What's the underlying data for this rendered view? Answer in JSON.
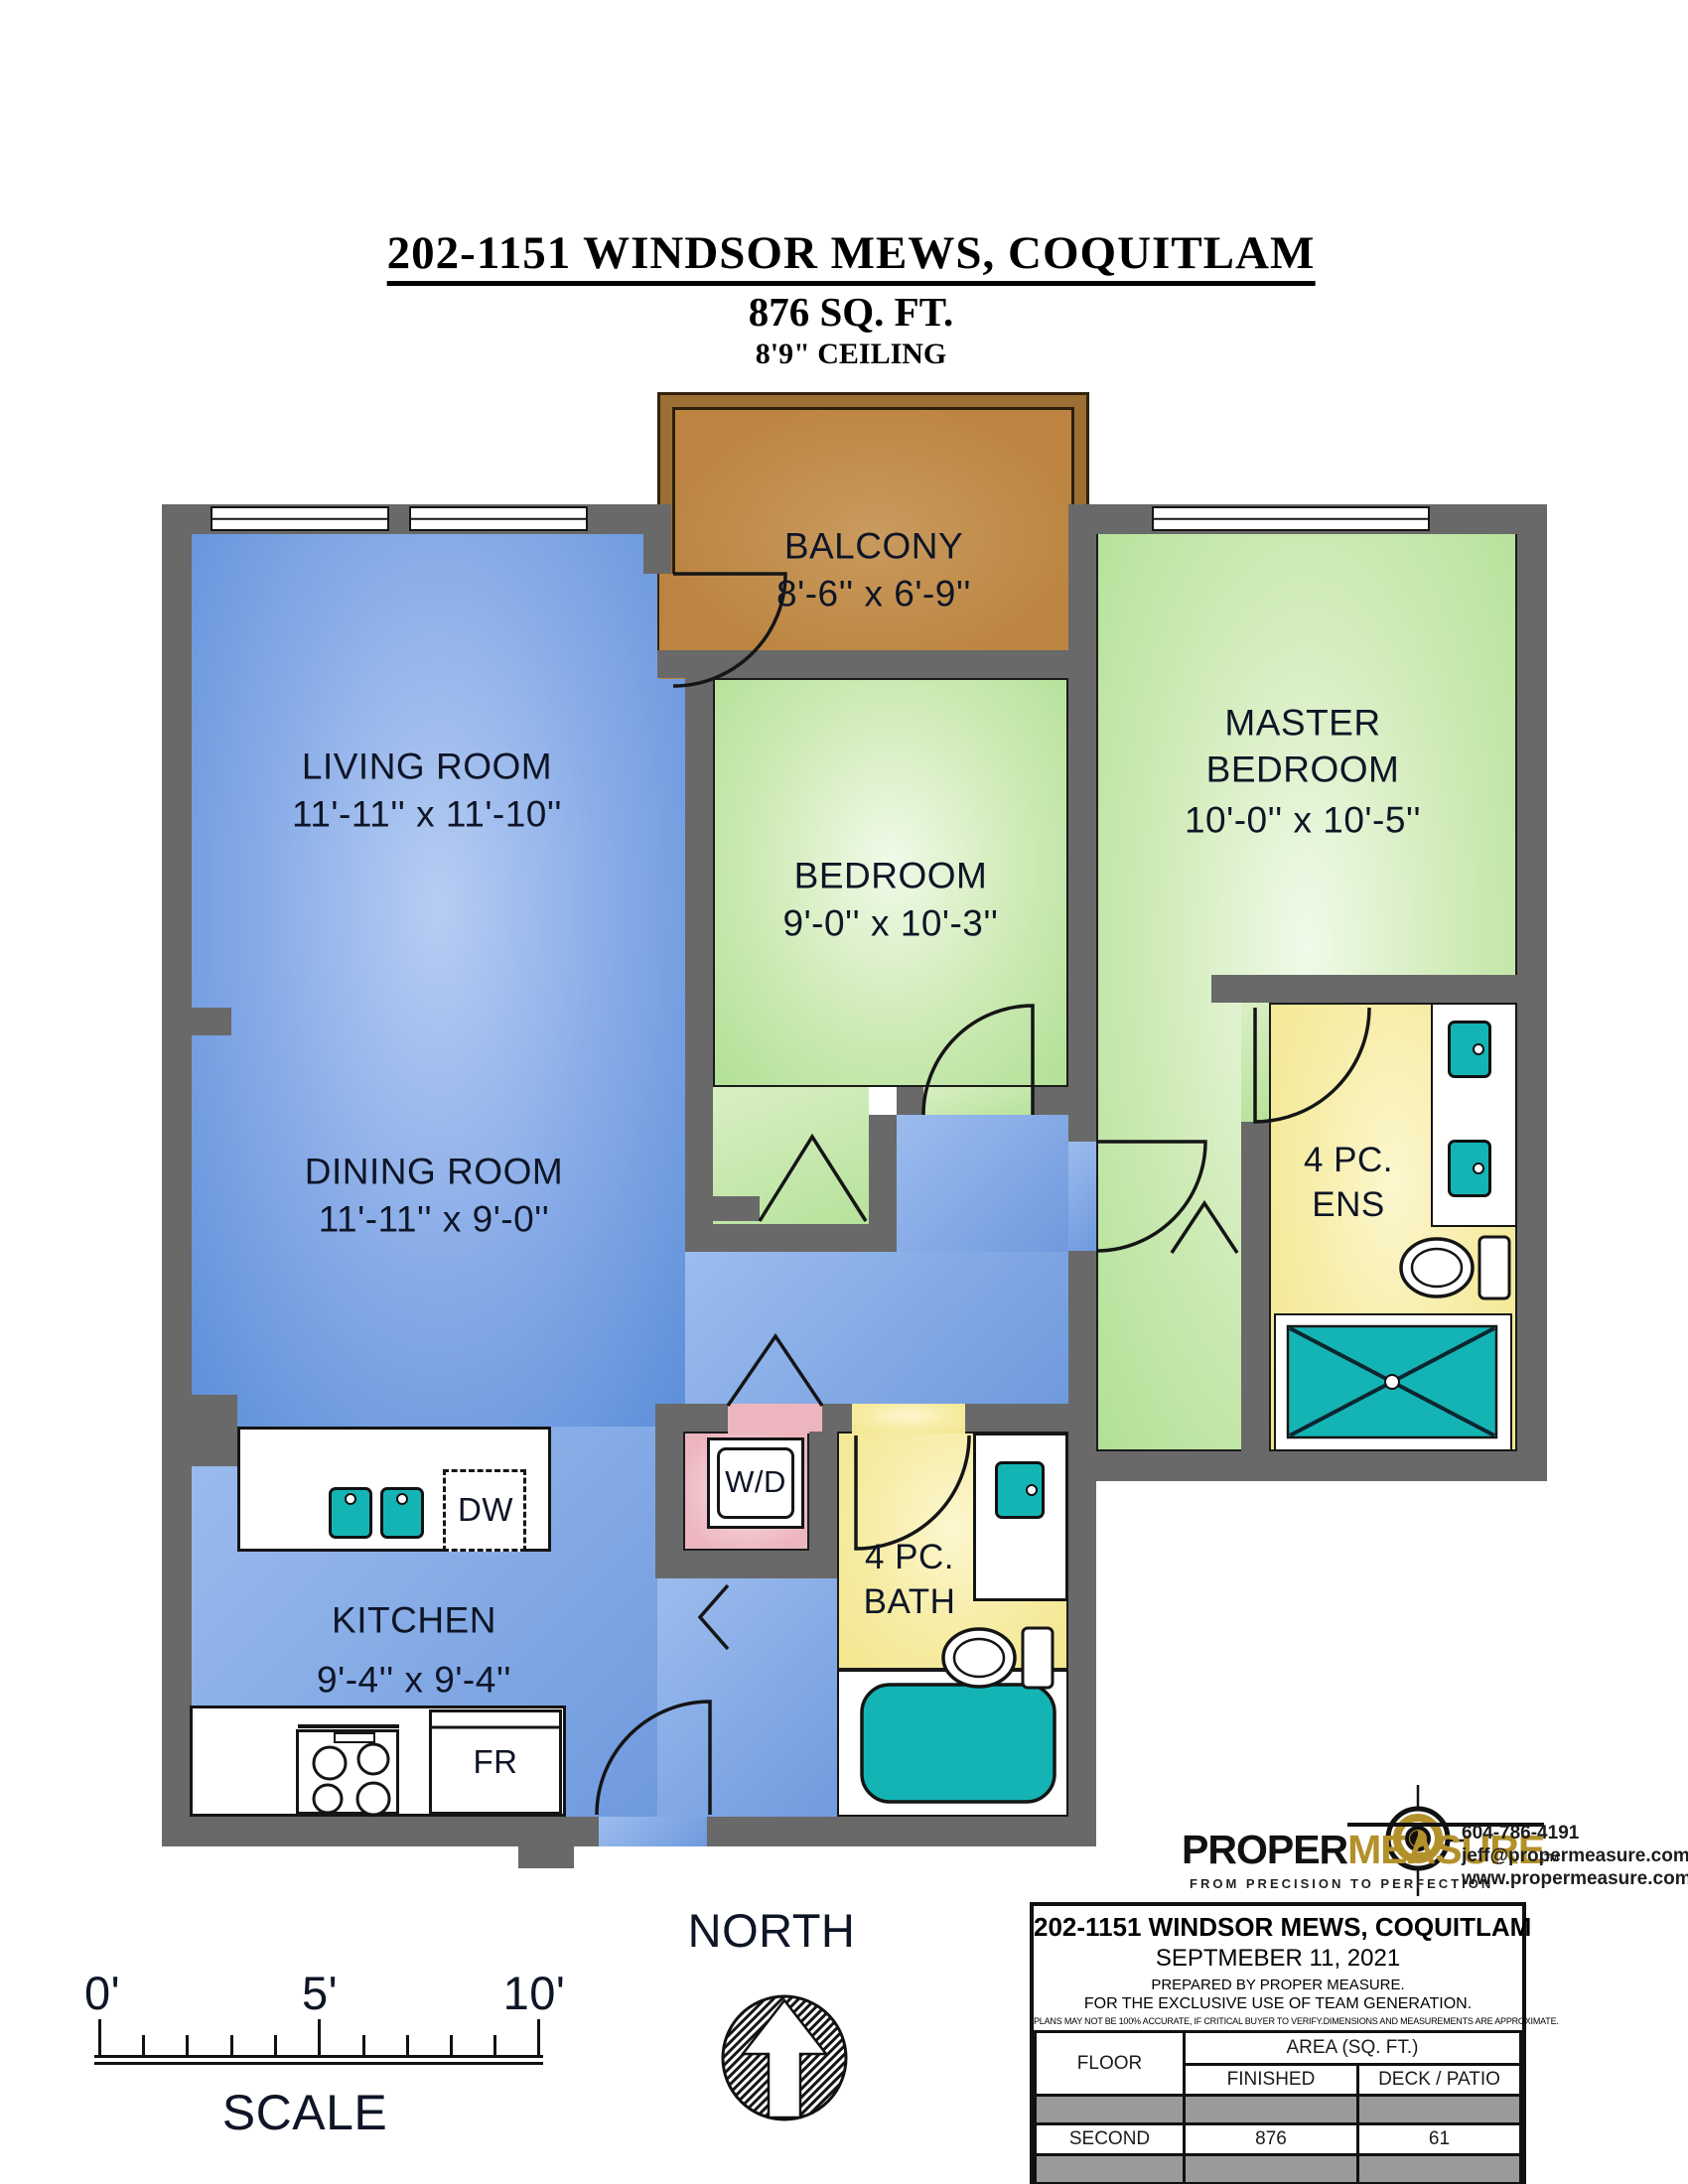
{
  "header": {
    "title": "202-1151 WINDSOR MEWS, COQUITLAM",
    "area": "876 SQ. FT.",
    "ceiling": "8'9\" CEILING"
  },
  "rooms": {
    "balcony": {
      "name": "BALCONY",
      "dims": "8'-6'' x 6'-9''"
    },
    "living": {
      "name": "LIVING ROOM",
      "dims": "11'-11'' x 11'-10''"
    },
    "master": {
      "name": "MASTER BEDROOM",
      "dims": "10'-0'' x 10'-5''"
    },
    "bedroom": {
      "name": "BEDROOM",
      "dims": "9'-0'' x 10'-3''"
    },
    "dining": {
      "name": "DINING ROOM",
      "dims": "11'-11'' x 9'-0''"
    },
    "ensuite": {
      "name": "4 PC. ENS"
    },
    "bath": {
      "name": "4 PC. BATH"
    },
    "kitchen": {
      "name": "KITCHEN",
      "dims": "9'-4'' x 9'-4''"
    }
  },
  "fixtures": {
    "washer_dryer": "W/D",
    "dishwasher": "DW",
    "fridge": "FR"
  },
  "compass": {
    "label": "NORTH"
  },
  "scalebar": {
    "ticks": [
      "0'",
      "5'",
      "10'"
    ],
    "caption": "SCALE"
  },
  "logo": {
    "name_black": "PROPER",
    "name_gold": "MEASURE",
    "tm": "TM",
    "tagline": "FROM PRECISION TO PERFECTION",
    "phone": "604-786-4191",
    "email": "jeff@propermeasure.com",
    "website": "www.propermeasure.com"
  },
  "infobox": {
    "title": "202-1151 WINDSOR MEWS, COQUITLAM",
    "date": "SEPTMEBER 11, 2021",
    "prepared": "PREPARED BY PROPER MEASURE.",
    "exclusive": "FOR THE EXCLUSIVE USE OF TEAM GENERATION.",
    "disclaimer": "PLANS MAY NOT BE 100% ACCURATE, IF CRITICAL BUYER TO VERIFY.DIMENSIONS AND MEASUREMENTS ARE APPROXIMATE.",
    "table": {
      "floor_header": "FLOOR",
      "area_header": "AREA (SQ. FT.)",
      "finished_header": "FINISHED",
      "deck_header": "DECK / PATIO",
      "rows": [
        {
          "floor": "SECOND",
          "finished": "876",
          "deck": "61"
        }
      ]
    }
  },
  "colors": {
    "wall": "#696969",
    "floor_blue": "#5c8ed9",
    "floor_green": "#b2e096",
    "floor_yellow": "#f3e78e",
    "floor_pink": "#edb6bf",
    "balcony_brown": "#bc8440",
    "fixture_teal": "#14b4b4",
    "logo_gold": "#b3912a",
    "table_gray": "#9a9a9a"
  }
}
